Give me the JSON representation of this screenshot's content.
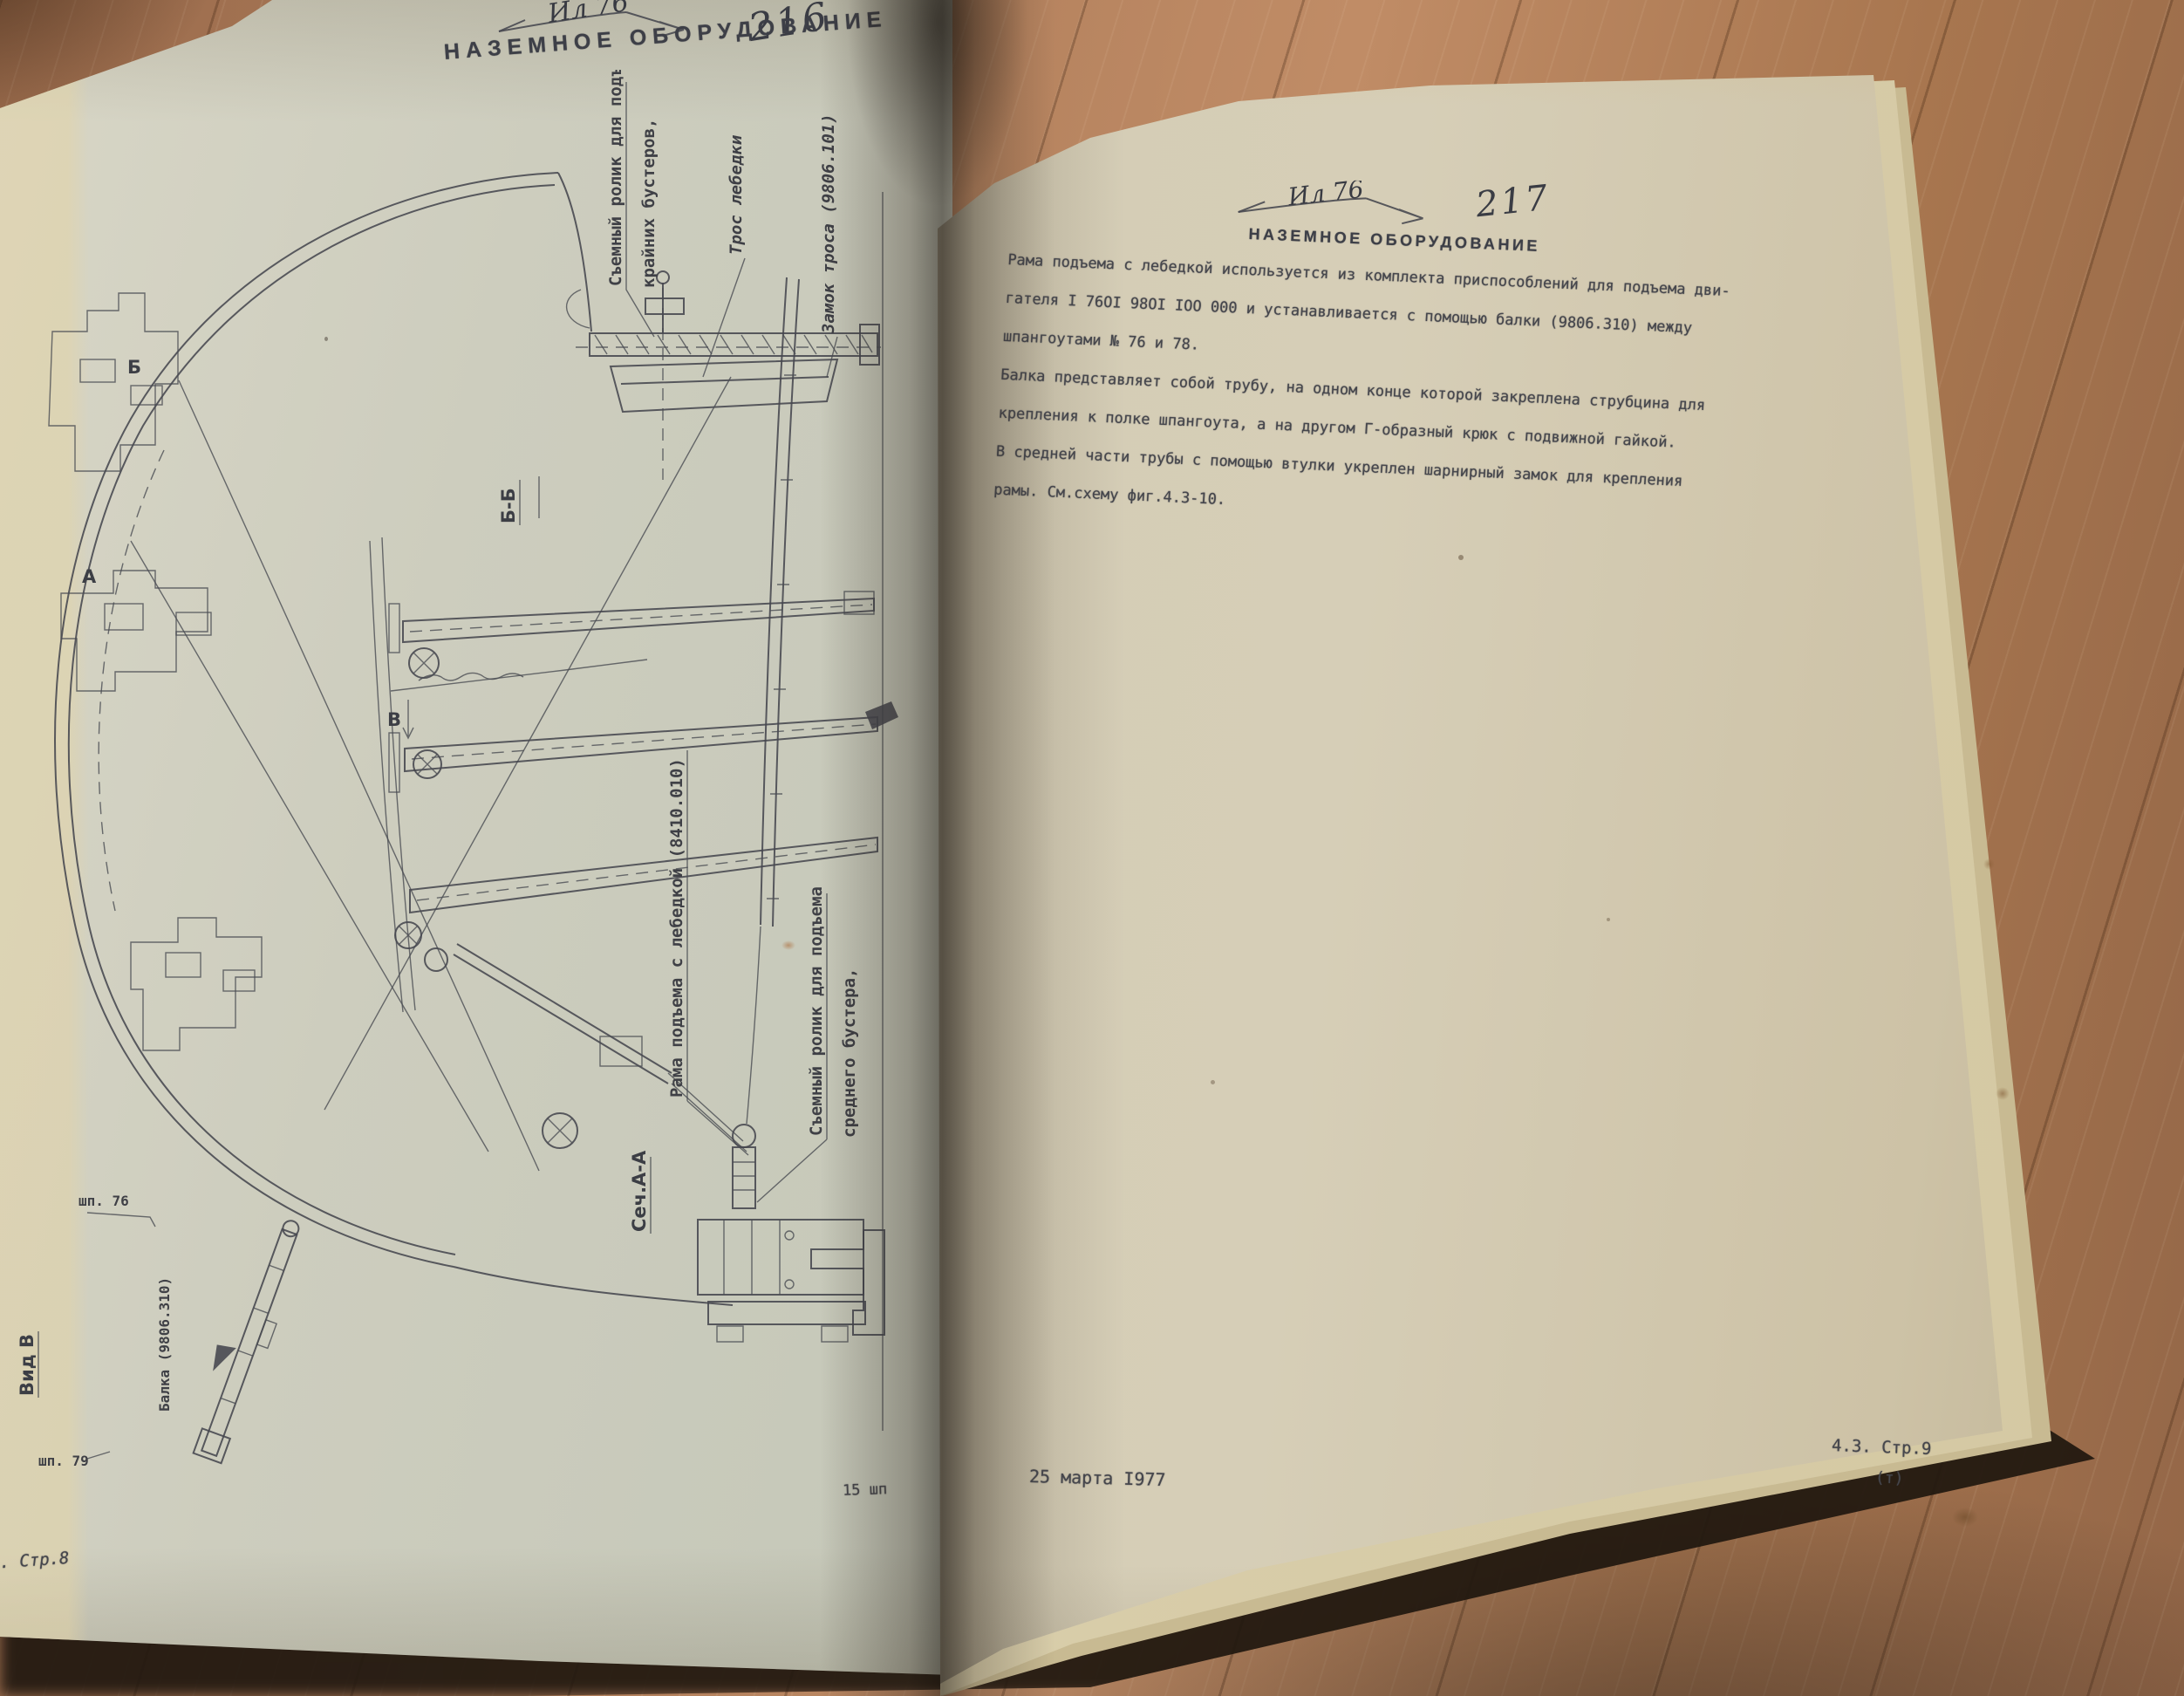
{
  "colors": {
    "paper_left": "#c6c8ba",
    "paper_right": "#d2cbb4",
    "wood": "#a97a5b",
    "ink": "#45464c",
    "shadow": "#211810"
  },
  "book": {
    "left_page": {
      "header": {
        "model": "Ил 76",
        "page_number": "216",
        "title": "НАЗЕМНОЕ ОБОРУДОВАНИЕ"
      },
      "figure_labels": {
        "roller_outer_line1": "Съемный ролик для подъема",
        "roller_outer_line2": "крайних бустеров,",
        "winch_cable": "Трос лебедки",
        "cable_lock": "Замок троса (9806.101)",
        "section_bb": "Б-Б",
        "marker_v": "В",
        "marker_b": "Б",
        "marker_a": "А",
        "lift_frame": "Рама подъема с лебедкой (8410.010)",
        "roller_middle_line1": "Съемный ролик для подъема",
        "roller_middle_line2": "среднего бустера,",
        "section_aa": "Сеч.А-А",
        "view_v": "Вид В",
        "frame_76": "шп. 76",
        "frame_79": "шп. 79",
        "beam_ref": "Балка (9806.310)"
      },
      "footer": {
        "page_ref": "3. Стр.8",
        "signature": "15 шп"
      }
    },
    "right_page": {
      "header": {
        "model": "Ил 76",
        "page_number": "217",
        "title": "НАЗЕМНОЕ ОБОРУДОВАНИЕ"
      },
      "paragraph_lines": [
        "Рама подъема с лебедкой используется из комплекта приспособлений для подъема дви-",
        "гателя  I 76OI 98OI IOO 000 и устанавливается с помощью балки  (9806.310)  между",
        "шпангоутами № 76 и 78.",
        "Балка представляет собой трубу, на одном конце которой закреплена струбцина для",
        "крепления к полке шпангоута, а на другом Г-образный крюк с подвижной гайкой.",
        "В средней части трубы с помощью втулки укреплен шарнирный замок для крепления",
        "рамы. См.схему фиг.4.3-10."
      ],
      "footer": {
        "date": "25 марта  I977",
        "ref": "4.3. Стр.9",
        "ref_note": "(т)"
      }
    }
  }
}
